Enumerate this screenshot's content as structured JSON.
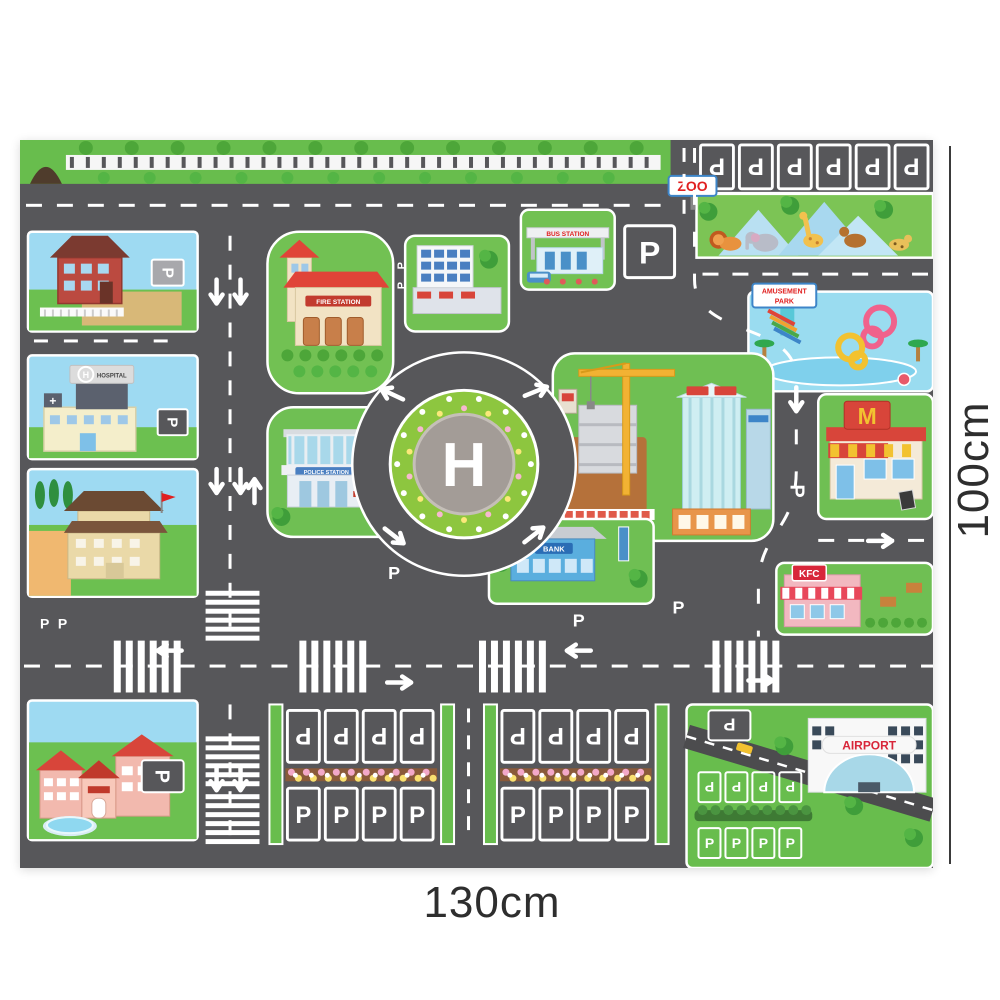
{
  "dimensions": {
    "width_label": "130cm",
    "height_label": "100cm"
  },
  "mat": {
    "letters": {
      "helipad": "H",
      "parking": "P",
      "hospital_roof": "H",
      "hospital_cross": "+"
    },
    "signs": {
      "zoo": "ZOO",
      "amusement_park_line1": "AMUSEMENT",
      "amusement_park_line2": "PARK",
      "bus_station": "BUS STATION",
      "fire_station": "FIRE STATION",
      "police_station": "POLICE STATION",
      "bank": "BANK",
      "hospital": "HOSPITAL",
      "airport": "AIRPORT",
      "kfc": "KFC",
      "mcdonalds": "M"
    },
    "colors": {
      "road": "#57575a",
      "grass": "#68bd4d",
      "sky": "#9edaf2",
      "water": "#9adcf0",
      "flower_ring": "#8dc63f",
      "helipad_center": "#a39c97",
      "accent_red": "#d8453a",
      "accent_blue": "#4a7fc1"
    }
  }
}
